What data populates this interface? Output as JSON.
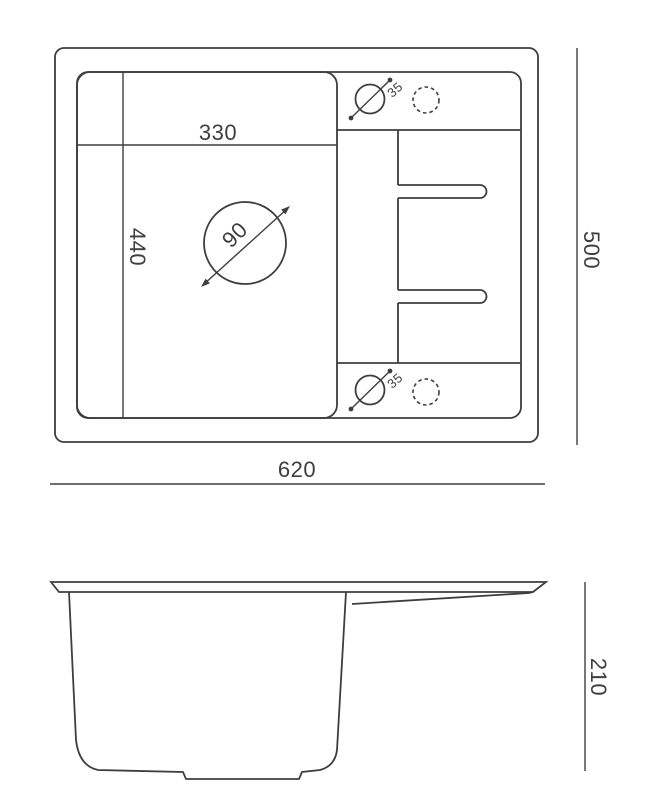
{
  "colors": {
    "background": "#ffffff",
    "line": "#3e3e3e",
    "text": "#3e3e3e"
  },
  "top_view": {
    "overall_width": "620",
    "overall_depth": "500",
    "bowl_width": "330",
    "bowl_depth": "440",
    "drain_diameter": "90",
    "top_tap_hole_diameter": "35",
    "bottom_tap_hole_diameter": "35"
  },
  "side_view": {
    "overall_height": "210"
  }
}
